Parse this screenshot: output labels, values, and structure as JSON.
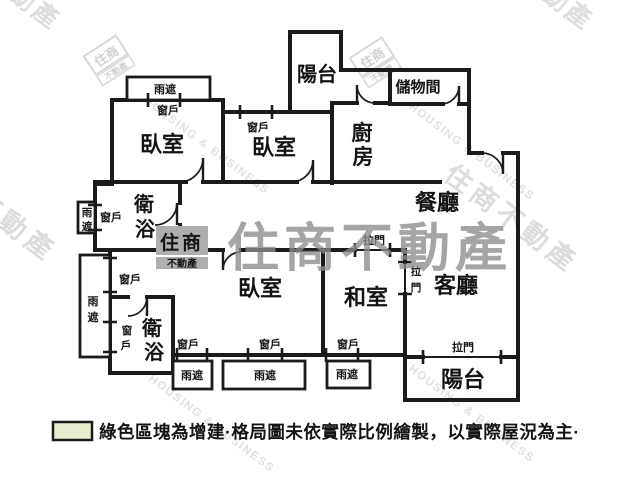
{
  "plan": {
    "rooms": {
      "bedroom": "臥室",
      "dining": "餐廳",
      "living": "客廳",
      "washitsu": "和室",
      "balcony": "陽台",
      "storage": "儲物間",
      "kitchen_chars": [
        "廚",
        "房"
      ],
      "bath_chars": [
        "衛",
        "浴"
      ]
    },
    "fixtures": {
      "window": "窗戶",
      "window_chars": [
        "窗",
        "戶"
      ],
      "canopy": "雨遮",
      "canopy_chars": [
        "雨",
        "遮"
      ],
      "sliding_door": "拉門",
      "sliding_chars": [
        "拉",
        "門"
      ]
    }
  },
  "legend": {
    "swatch_color": "#e9eccf",
    "text": "綠色區塊為增建·格局圖未依實際比例繪製，以實際屋況為主·"
  },
  "watermark": {
    "brand": "住商不動產",
    "brand_main": "住商",
    "brand_sub": "不動產",
    "company_en": "HOUSING & BUSINESS",
    "corner_tl": "動產",
    "corner_tr": "不動產"
  },
  "colors": {
    "wall": "#1b1b1b",
    "brand_gray": "#8d8d8d",
    "faint_gray": "#dcdcdc",
    "legend_swatch": "#e9eccf"
  }
}
